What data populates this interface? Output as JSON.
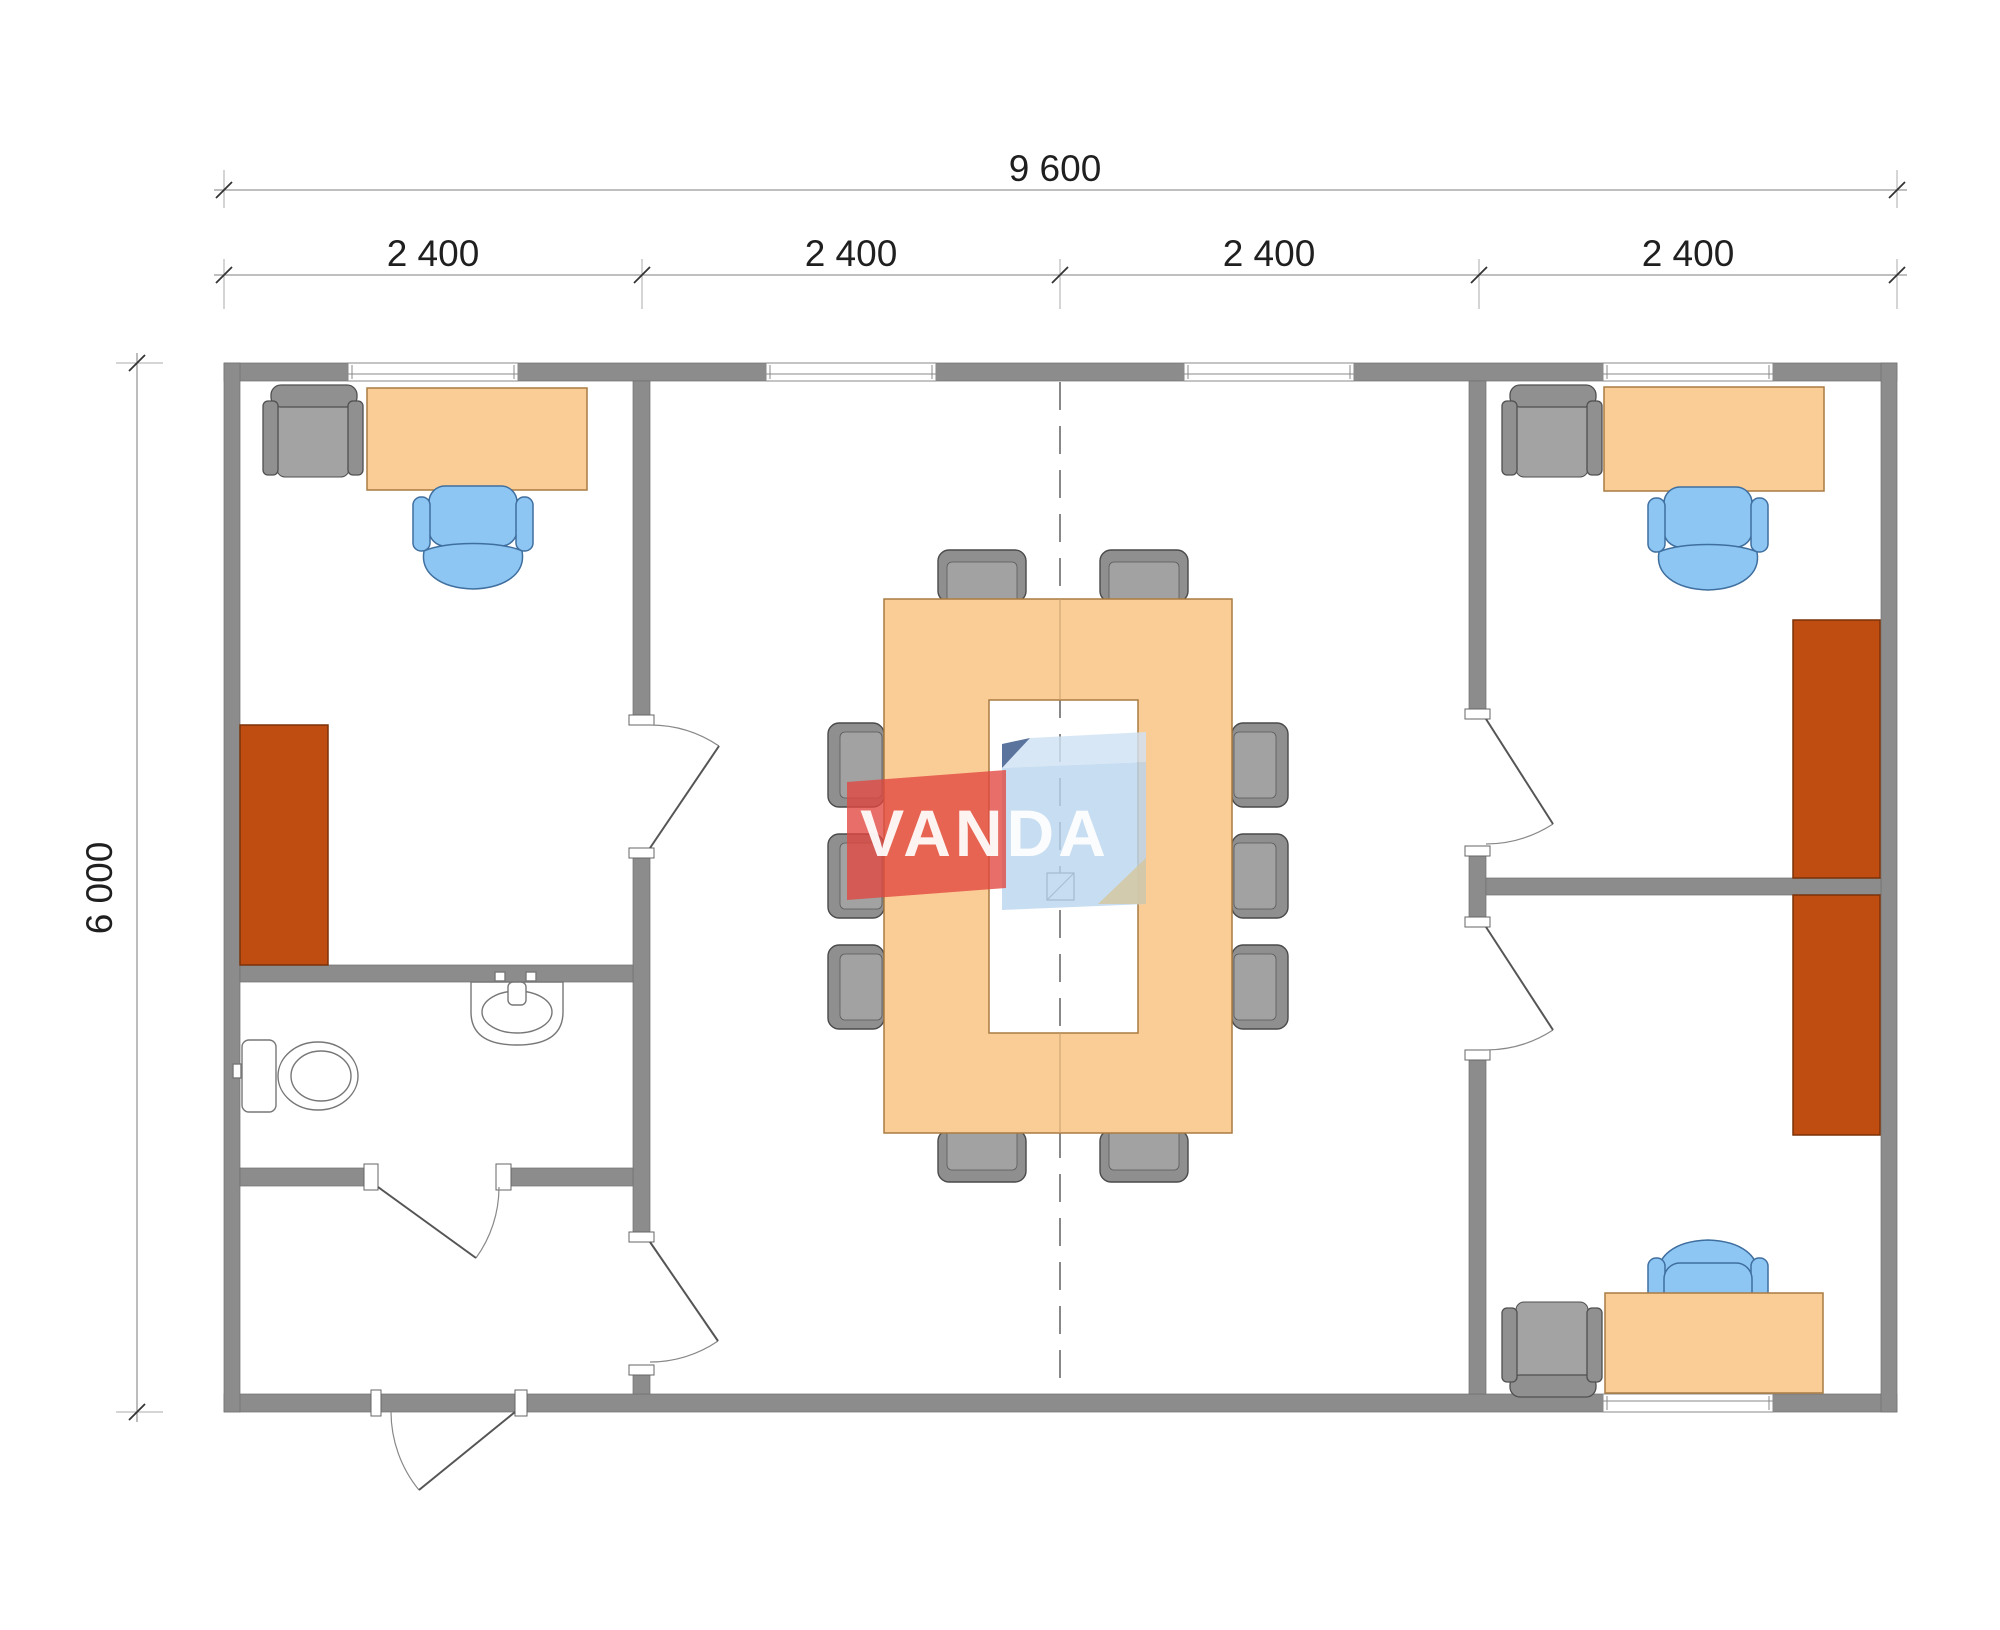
{
  "title": "Office container floor plan",
  "dimensions": {
    "total_width_label": "9 600",
    "module_labels": [
      "2 400",
      "2 400",
      "2 400",
      "2 400"
    ],
    "height_label": "6 000"
  },
  "logo": {
    "text": "VANDA"
  },
  "theme": {
    "wall_color": "#8c8c8c",
    "wood_color": "#fbcd96",
    "wood_border": "#a97c42",
    "cabinet_color": "#bf4d12",
    "cabinet_border": "#7a3209",
    "chair_blue": "#8ec6f3",
    "chair_blue_border": "#3f6f9f",
    "chair_gray": "#909090",
    "chair_gray_border": "#4f4f4f",
    "fixture_stroke": "#777777",
    "line_color": "#999999",
    "tick_color": "#333333",
    "text_color": "#1f1f1f",
    "dash_color": "#555555",
    "logo_red": "#e2473f",
    "logo_blue": "#b9d4ee",
    "logo_blue_light": "#cfe2f4",
    "logo_navy": "#23457c",
    "logo_beige": "#d6c79e",
    "logo_text": "#ffffff"
  }
}
